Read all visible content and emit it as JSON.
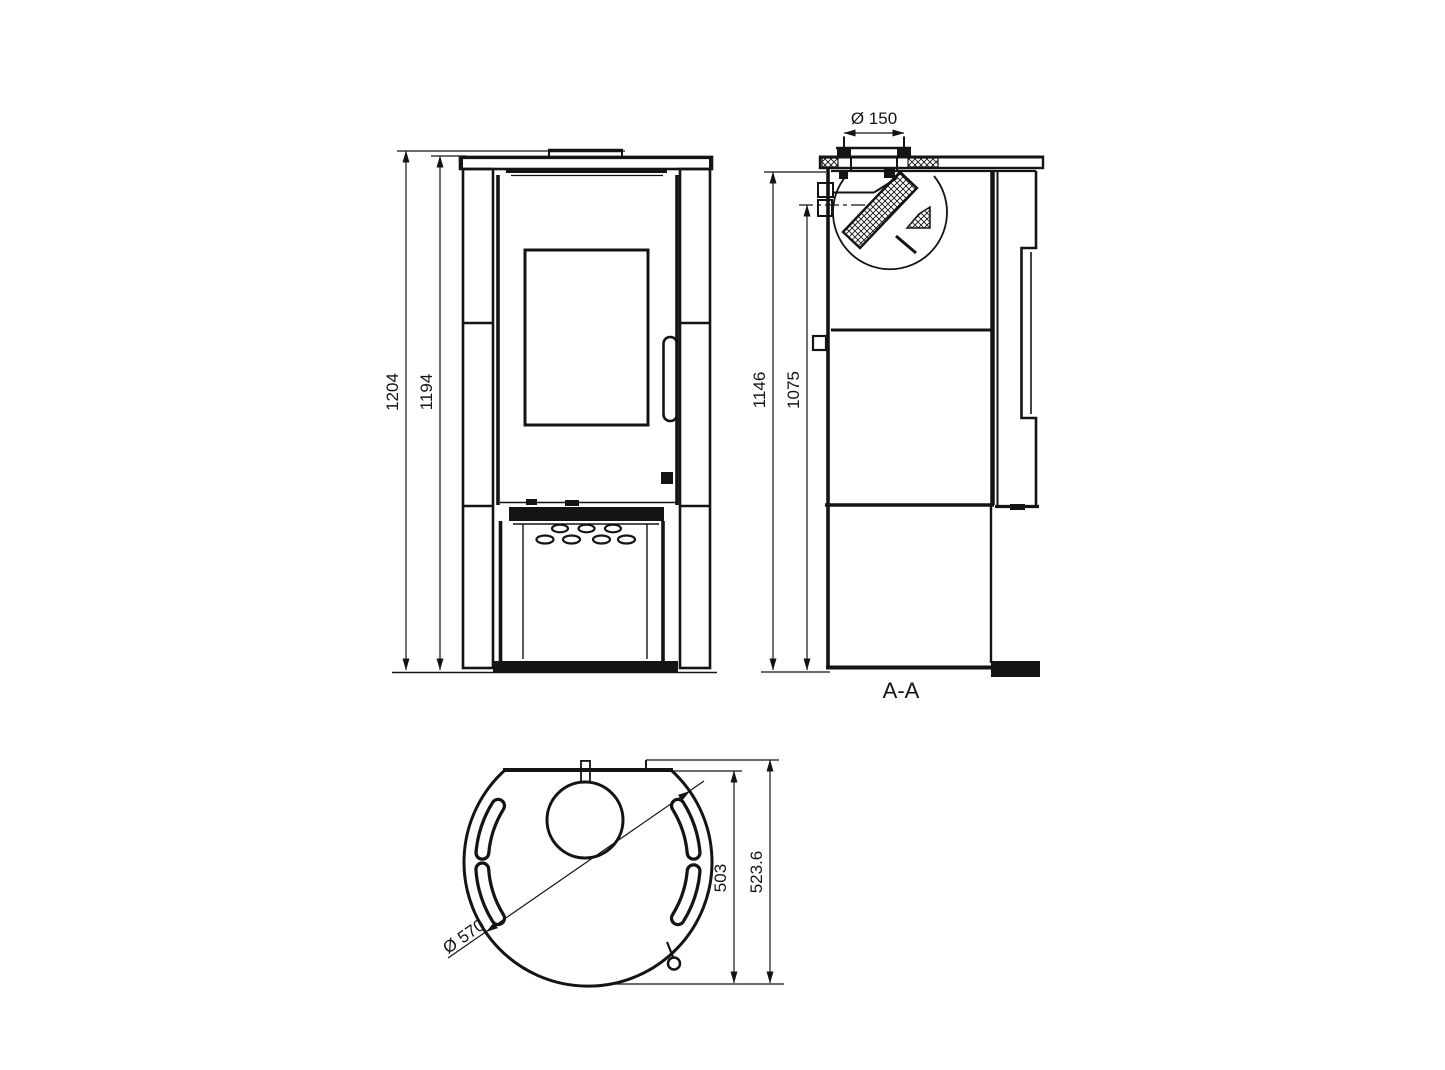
{
  "colors": {
    "background": "#ffffff",
    "line": "#141414"
  },
  "front_view": {
    "dim_total_height": "1204",
    "dim_body_height": "1194"
  },
  "section_view": {
    "label": "A-A",
    "dim_flue_diameter": "Ø 150",
    "dim_overall_height": "1146",
    "dim_flue_axis_height": "1075"
  },
  "plan_view": {
    "dim_diameter": "Ø 570",
    "dim_body_depth": "503",
    "dim_overall_depth": "523.6"
  }
}
